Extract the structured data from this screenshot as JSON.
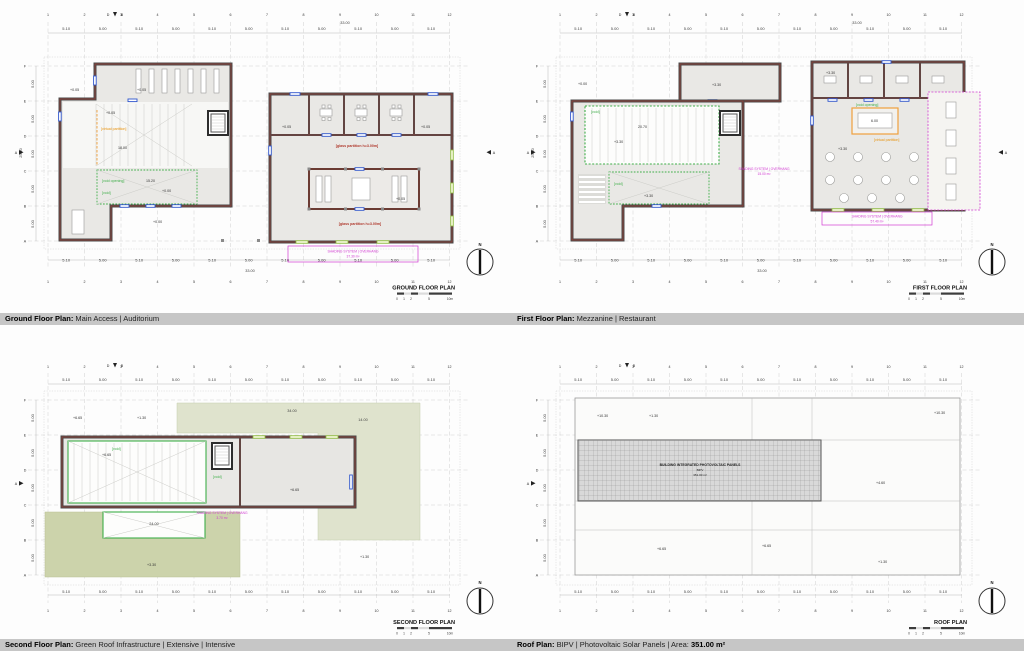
{
  "captions": [
    {
      "bold": "Ground Floor Plan:",
      "rest": " Main Access | Auditorium",
      "bold2": ""
    },
    {
      "bold": "First Floor Plan:",
      "rest": " Mezzanine | Restaurant",
      "bold2": ""
    },
    {
      "bold": "Second Floor Plan:",
      "rest": " Green Roof Infrastructure | Extensive | Intensive",
      "bold2": ""
    },
    {
      "bold": "Roof Plan:",
      "rest": " BIPV | Photovoltaic Solar Panels | Area: ",
      "bold2": "351.00 m²"
    }
  ],
  "scale": [
    "0",
    "1",
    "2",
    "5",
    "10m"
  ],
  "north": "N",
  "sections": {
    "top_left": "D",
    "top_right": "B",
    "side": "A"
  },
  "grid": {
    "cols": [
      "1",
      "2",
      "3",
      "4",
      "5",
      "6",
      "7",
      "8",
      "9",
      "10",
      "11",
      "12"
    ],
    "rows": [
      "F",
      "E",
      "D",
      "C",
      "B",
      "A"
    ]
  },
  "dims": {
    "top": [
      "5.10",
      "5.00",
      "5.10",
      "5.00",
      "5.10",
      "5.00",
      "5.10",
      "5.00",
      "5.10",
      "5.00",
      "5.10"
    ],
    "bottom": [
      "5.10",
      "5.00",
      "5.10",
      "5.00",
      "5.10",
      "5.00",
      "5.10",
      "5.00",
      "5.10",
      "5.00",
      "5.10"
    ],
    "left": [
      "5.00",
      "5.00",
      "5.00",
      "5.00",
      "5.00"
    ]
  },
  "plans": [
    {
      "name": "GROUND FLOOR PLAN",
      "totals": {
        "top": "33.00",
        "bottom": "33.00",
        "left": "25.00"
      },
      "labels": {
        "lvl_entry": "+0.05",
        "lvl_stage": "+0.05",
        "lvl_hall": "+0.05",
        "hall_w": "18.00",
        "virtual_partition": "[virtual partition]",
        "void_opening": "[void opening]",
        "void": "[void]",
        "void_w": "15.20",
        "lvl_void": "+0.00",
        "lvl_plaza": "+0.00",
        "glass1": "[glass partition h=3.00m]",
        "glass2": "[glass partition h=3.00m]",
        "lvl_room_l": "+0.05",
        "lvl_room_r": "+0.05",
        "lvl_aud": "+0.05",
        "shading1": "SHADING SYSTEM | OVERHANG",
        "shading2": "37.30 m²"
      }
    },
    {
      "name": "FIRST FLOOR PLAN",
      "totals": {
        "top": "33.00",
        "bottom": "33.00",
        "left": "25.00"
      },
      "labels": {
        "lvl_out": "+0.00",
        "lvl_conn": "+3.30",
        "lvl_rooms": "+3.30",
        "void1": "[void]",
        "mezz_w": "20.70",
        "lvl_mezz": "+3.30",
        "void2": "[void]",
        "lvl_void2": "+3.30",
        "void_opening": "[void opening]",
        "skylight_w": "6.00",
        "virtual_partition": "[virtual partition]",
        "lvl_rest": "+3.30",
        "shading_mid1": "SHADING SYSTEM | OVERHANG",
        "shading_mid2": "15.00 m²",
        "shading1": "SHADING SYSTEM | OVERHANG",
        "shading2": "57.40 m²"
      }
    },
    {
      "name": "SECOND FLOOR PLAN",
      "labels": {
        "lvl_tl": "+6.65",
        "lvl_t2": "+1.30",
        "roof_top_w": "34.00",
        "roof_right_w": "14.00",
        "void": "[void]",
        "lvl_void": "+6.65",
        "lvl_room": "+6.65",
        "void2": "[void]",
        "shading1": "SHADING SYSTEM | OVERHANG",
        "shading2": "3.70 m²",
        "terrace_w": "24.00",
        "lvl_terrace": "+3.30",
        "lvl_r": "+1.30"
      }
    },
    {
      "name": "ROOF PLAN",
      "labels": {
        "lvl1": "+10.30",
        "lvl2": "+1.30",
        "lvl3": "+10.30",
        "lvl4": "+4.60",
        "lvl5": "+6.65",
        "lvl6": "+6.65",
        "lvl7": "+1.30",
        "pv1": "BUILDING INTEGRATED PHOTOVOLTAIC PANELS",
        "pv2": "BIPV",
        "pv3": "351.00 m²"
      }
    }
  ]
}
